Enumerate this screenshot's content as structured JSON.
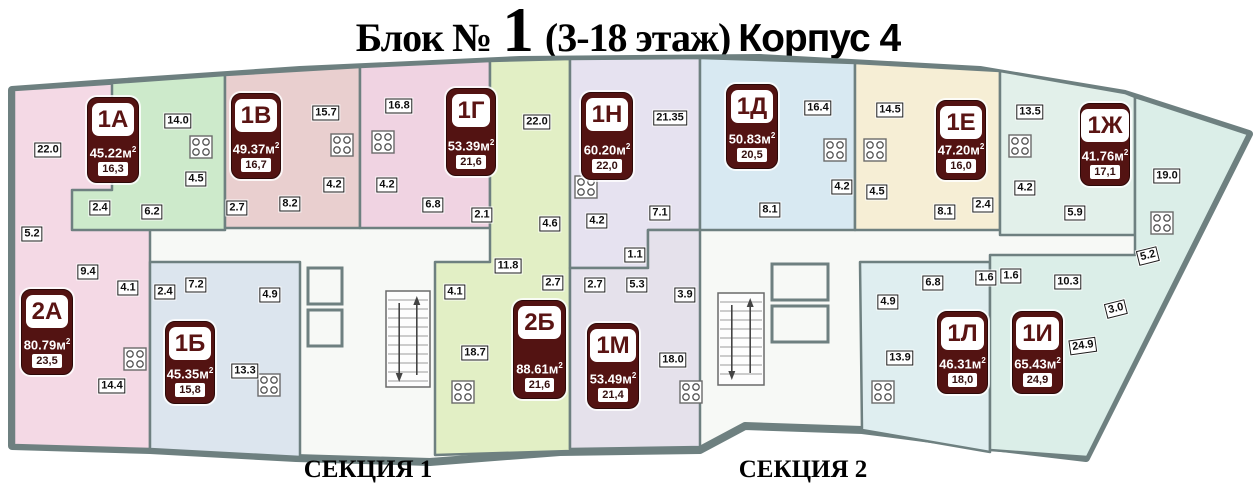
{
  "title": {
    "prefix": "Блок № ",
    "number": "1",
    "suffix": " (3-18 этаж)",
    "corpus": "Корпус 4"
  },
  "sections": [
    {
      "label": "СЕКЦИЯ 1",
      "x": 368,
      "y": 470
    },
    {
      "label": "СЕКЦИЯ 2",
      "x": 803,
      "y": 470
    }
  ],
  "area_unit": "м",
  "area_sup": "2",
  "colors": {
    "wall": "#6e8080",
    "floor_bg": "#f7f9f6",
    "badge_bg": "#531312",
    "badge_text": "#ffffff",
    "badge_id_text": "#5a1413"
  },
  "apartments": [
    {
      "id": "1А",
      "total": "45.22",
      "living": "16,3",
      "color": "#cdeacb",
      "badge": {
        "x": 87,
        "y": 97,
        "w": 52,
        "h": 86
      }
    },
    {
      "id": "1В",
      "total": "49.37",
      "living": "16,7",
      "color": "#e9cfcf",
      "badge": {
        "x": 231,
        "y": 93,
        "w": 50,
        "h": 86
      }
    },
    {
      "id": "1Г",
      "total": "53.39",
      "living": "21,6",
      "color": "#f0d3e2",
      "badge": {
        "x": 446,
        "y": 88,
        "w": 50,
        "h": 88
      }
    },
    {
      "id": "1Н",
      "total": "60.20",
      "living": "22,0",
      "color": "#e6e2f0",
      "badge": {
        "x": 581,
        "y": 92,
        "w": 52,
        "h": 88
      }
    },
    {
      "id": "1Д",
      "total": "50.83",
      "living": "20,5",
      "color": "#d8e9f2",
      "badge": {
        "x": 726,
        "y": 84,
        "w": 52,
        "h": 85
      }
    },
    {
      "id": "1Е",
      "total": "47.20",
      "living": "16,0",
      "color": "#f6eed5",
      "badge": {
        "x": 936,
        "y": 100,
        "w": 50,
        "h": 80
      }
    },
    {
      "id": "1Ж",
      "total": "41.76",
      "living": "17,1",
      "color": "#e2f0ea",
      "badge": {
        "x": 1080,
        "y": 103,
        "w": 50,
        "h": 83
      }
    },
    {
      "id": "2А",
      "total": "80.79",
      "living": "23,5",
      "color": "#f4d9e5",
      "badge": {
        "x": 21,
        "y": 289,
        "w": 52,
        "h": 86
      }
    },
    {
      "id": "1Б",
      "total": "45.35",
      "living": "15,8",
      "color": "#dce5ee",
      "badge": {
        "x": 165,
        "y": 321,
        "w": 50,
        "h": 83
      }
    },
    {
      "id": "2Б",
      "total": "88.61",
      "living": "21,6",
      "color": "#e2efc5",
      "badge": {
        "x": 513,
        "y": 300,
        "w": 53,
        "h": 99
      }
    },
    {
      "id": "1М",
      "total": "53.49",
      "living": "21,4",
      "color": "#e5e1eb",
      "badge": {
        "x": 587,
        "y": 323,
        "w": 52,
        "h": 86
      }
    },
    {
      "id": "1Л",
      "total": "46.31",
      "living": "18,0",
      "color": "#dfeef0",
      "badge": {
        "x": 937,
        "y": 311,
        "w": 51,
        "h": 83
      }
    },
    {
      "id": "1И",
      "total": "65.43",
      "living": "24,9",
      "color": "#dbeee8",
      "badge": {
        "x": 1012,
        "y": 311,
        "w": 51,
        "h": 83
      }
    }
  ],
  "room_labels": [
    {
      "t": "22.0",
      "x": 48,
      "y": 150
    },
    {
      "t": "14.0",
      "x": 178,
      "y": 121
    },
    {
      "t": "4.5",
      "x": 196,
      "y": 179
    },
    {
      "t": "2.4",
      "x": 100,
      "y": 208
    },
    {
      "t": "6.2",
      "x": 152,
      "y": 212
    },
    {
      "t": "5.2",
      "x": 32,
      "y": 234
    },
    {
      "t": "9.4",
      "x": 88,
      "y": 272
    },
    {
      "t": "4.1",
      "x": 128,
      "y": 288
    },
    {
      "t": "2.4",
      "x": 165,
      "y": 292
    },
    {
      "t": "7.2",
      "x": 196,
      "y": 285
    },
    {
      "t": "4.9",
      "x": 270,
      "y": 295
    },
    {
      "t": "13.3",
      "x": 245,
      "y": 371
    },
    {
      "t": "14.4",
      "x": 112,
      "y": 386
    },
    {
      "t": "2.7",
      "x": 237,
      "y": 208
    },
    {
      "t": "8.2",
      "x": 290,
      "y": 204
    },
    {
      "t": "15.7",
      "x": 326,
      "y": 113
    },
    {
      "t": "16.8",
      "x": 399,
      "y": 106
    },
    {
      "t": "4.2",
      "x": 334,
      "y": 185
    },
    {
      "t": "4.2",
      "x": 387,
      "y": 185
    },
    {
      "t": "6.8",
      "x": 433,
      "y": 205
    },
    {
      "t": "2.1",
      "x": 482,
      "y": 215
    },
    {
      "t": "22.0",
      "x": 537,
      "y": 122
    },
    {
      "t": "4.6",
      "x": 550,
      "y": 224
    },
    {
      "t": "4.2",
      "x": 597,
      "y": 221
    },
    {
      "t": "11.8",
      "x": 508,
      "y": 266
    },
    {
      "t": "2.7",
      "x": 553,
      "y": 283
    },
    {
      "t": "4.1",
      "x": 455,
      "y": 292
    },
    {
      "t": "18.7",
      "x": 475,
      "y": 353
    },
    {
      "t": "2.7",
      "x": 595,
      "y": 285
    },
    {
      "t": "5.3",
      "x": 637,
      "y": 285
    },
    {
      "t": "3.9",
      "x": 685,
      "y": 295
    },
    {
      "t": "18.0",
      "x": 673,
      "y": 360
    },
    {
      "t": "1.1",
      "x": 635,
      "y": 255
    },
    {
      "t": "21.35",
      "x": 670,
      "y": 118
    },
    {
      "t": "7.1",
      "x": 660,
      "y": 213
    },
    {
      "t": "16.4",
      "x": 818,
      "y": 108
    },
    {
      "t": "8.1",
      "x": 770,
      "y": 210
    },
    {
      "t": "4.2",
      "x": 842,
      "y": 187
    },
    {
      "t": "4.5",
      "x": 877,
      "y": 192
    },
    {
      "t": "14.5",
      "x": 890,
      "y": 110
    },
    {
      "t": "8.1",
      "x": 945,
      "y": 212
    },
    {
      "t": "2.4",
      "x": 983,
      "y": 205
    },
    {
      "t": "13.5",
      "x": 1030,
      "y": 112
    },
    {
      "t": "4.2",
      "x": 1025,
      "y": 188
    },
    {
      "t": "5.9",
      "x": 1075,
      "y": 213
    },
    {
      "t": "19.0",
      "x": 1167,
      "y": 176
    },
    {
      "t": "5.2",
      "x": 1148,
      "y": 256,
      "r": -14
    },
    {
      "t": "6.8",
      "x": 933,
      "y": 283
    },
    {
      "t": "4.9",
      "x": 888,
      "y": 302
    },
    {
      "t": "1.6",
      "x": 986,
      "y": 278
    },
    {
      "t": "1.6",
      "x": 1011,
      "y": 276
    },
    {
      "t": "10.3",
      "x": 1068,
      "y": 282
    },
    {
      "t": "3.0",
      "x": 1116,
      "y": 309,
      "r": -14
    },
    {
      "t": "13.9",
      "x": 900,
      "y": 358
    },
    {
      "t": "24.9",
      "x": 1083,
      "y": 346,
      "r": -8
    }
  ],
  "stoves": [
    [
      201,
      147
    ],
    [
      342,
      145
    ],
    [
      383,
      142
    ],
    [
      135,
      359
    ],
    [
      269,
      385
    ],
    [
      463,
      392
    ],
    [
      691,
      392
    ],
    [
      586,
      187
    ],
    [
      835,
      150
    ],
    [
      875,
      150
    ],
    [
      1020,
      146
    ],
    [
      1162,
      223
    ],
    [
      883,
      392
    ]
  ]
}
